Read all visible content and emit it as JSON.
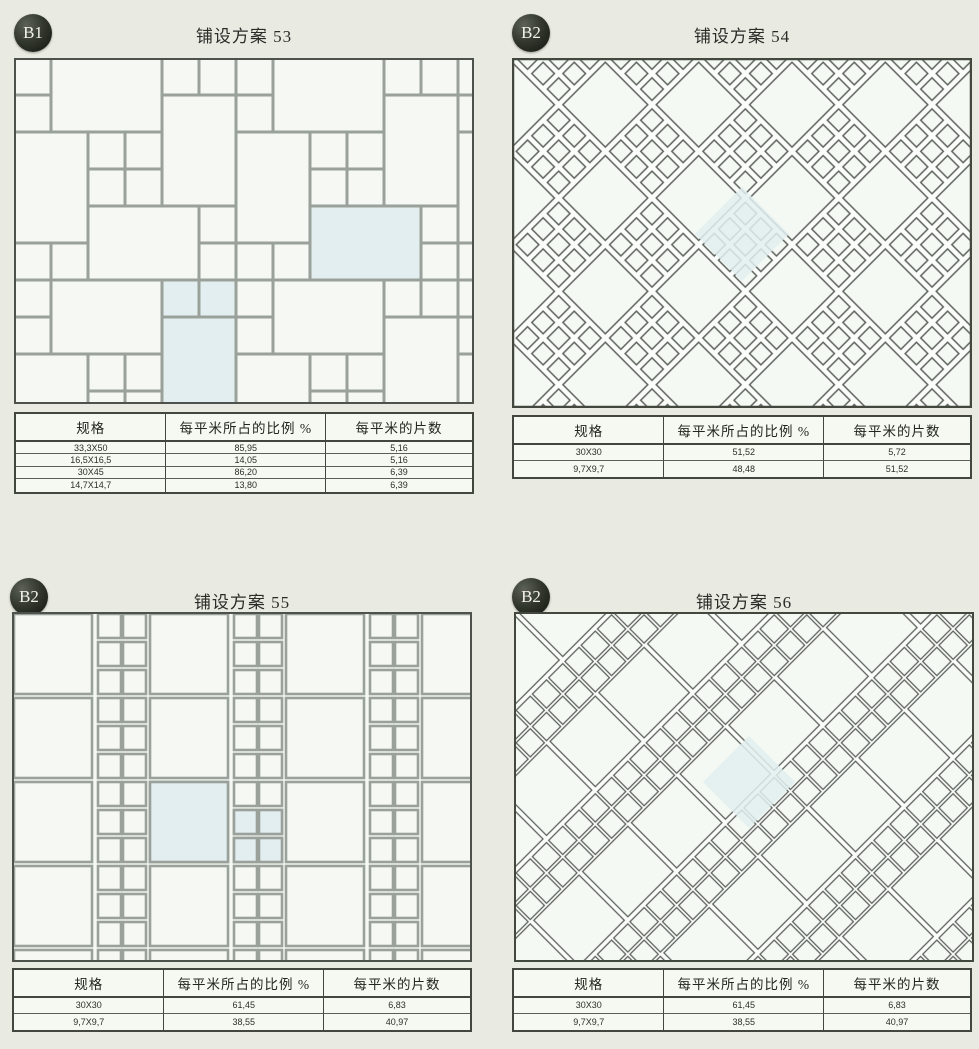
{
  "page": {
    "description": "Tile laying scheme catalog page",
    "colors": {
      "page_bg": "#e9ebe2",
      "grout_gray": "#9aa19a",
      "line_dark": "#5d635c",
      "tile_fill": "#f5f8f3",
      "highlight_tile": "#e2eef0",
      "badge_bg": "#23271f",
      "table_border": "#41463f"
    }
  },
  "panels": [
    {
      "badge": "B1",
      "title": "铺设方案 53",
      "pattern": "modular-pinwheel-rect-squares",
      "table": {
        "headers": [
          "规格",
          "每平米所占的比例 %",
          "每平米的片数"
        ],
        "rows": [
          [
            "33,3X50",
            "85,95",
            "5,16"
          ],
          [
            "16,5X16,5",
            "14,05",
            "5,16"
          ],
          [
            "30X45",
            "86,20",
            "6,39"
          ],
          [
            "14,7X14,7",
            "13,80",
            "6,39"
          ]
        ]
      }
    },
    {
      "badge": "B2",
      "title": "铺设方案 54",
      "pattern": "diagonal-checkerboard-large-with-3x3-small",
      "table": {
        "headers": [
          "规格",
          "每平米所占的比例 %",
          "每平米的片数"
        ],
        "rows": [
          [
            "30X30",
            "51,52",
            "5,72"
          ],
          [
            "9,7X9,7",
            "48,48",
            "51,52"
          ]
        ]
      }
    },
    {
      "badge": "B2",
      "title": "铺设方案 55",
      "pattern": "columns-large-squares-with-double-small-strips",
      "table": {
        "headers": [
          "规格",
          "每平米所占的比例 %",
          "每平米的片数"
        ],
        "rows": [
          [
            "30X30",
            "61,45",
            "6,83"
          ],
          [
            "9,7X9,7",
            "38,55",
            "40,97"
          ]
        ]
      }
    },
    {
      "badge": "B2",
      "title": "铺设方案 56",
      "pattern": "diagonal-large-squares-with-double-small-strips",
      "table": {
        "headers": [
          "规格",
          "每平米所占的比例 %",
          "每平米的片数"
        ],
        "rows": [
          [
            "30X30",
            "61,45",
            "6,83"
          ],
          [
            "9,7X9,7",
            "38,55",
            "40,97"
          ]
        ]
      }
    }
  ]
}
